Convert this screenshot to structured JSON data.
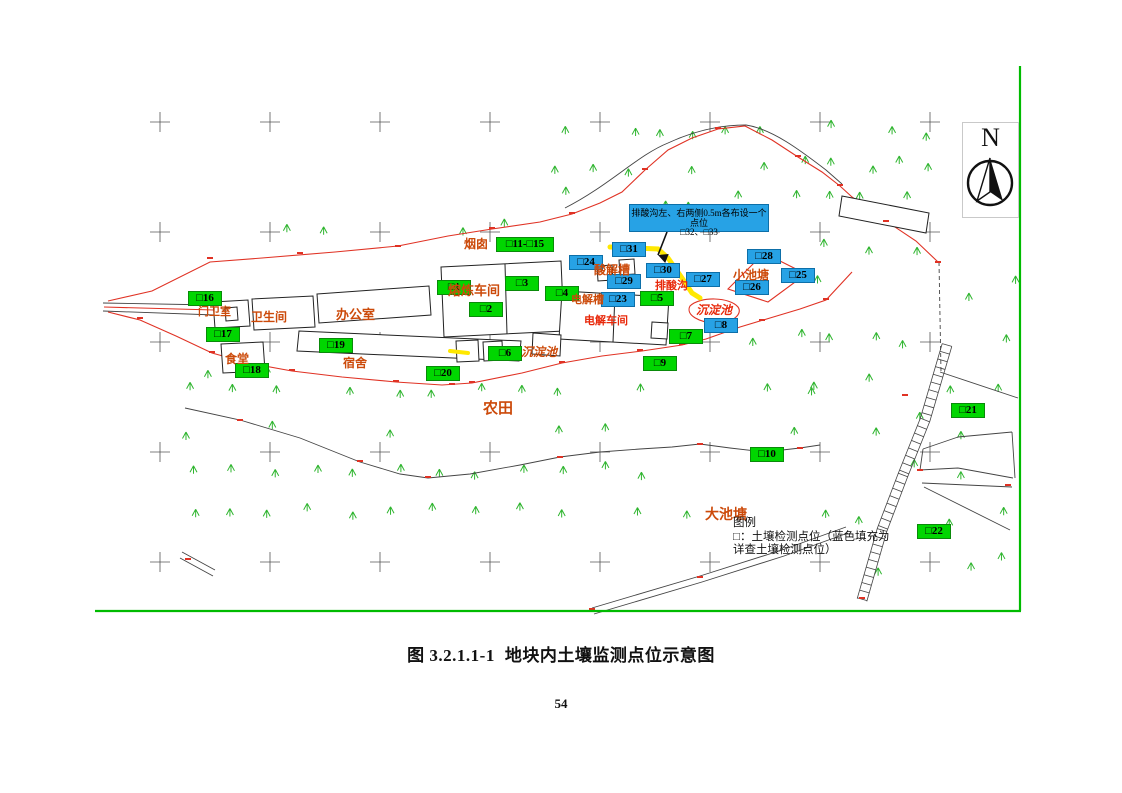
{
  "figure": {
    "caption_no": "图 3.2.1.1-1",
    "caption_title": "地块内土壤监测点位示意图",
    "page_number": "54"
  },
  "north": {
    "label": "N"
  },
  "callout": {
    "line1": "排酸沟左、右两侧0.5m各布设一个点位",
    "line2": "□32、□33"
  },
  "legend": {
    "title": "图例",
    "line1": "□：土壤检测点位（蓝色填充为",
    "line2": "详查土壤检测点位）"
  },
  "colors": {
    "point_green": "#00D600",
    "point_blue": "#27A2E5",
    "boundary_red": "#E03224",
    "label_orange": "#CC4A0A",
    "label_red": "#E8280A",
    "ditch_yellow": "#FFE800",
    "frame_green": "#00BB00",
    "tree_green": "#2FB52F"
  },
  "points": [
    {
      "id": "1",
      "label": "□1",
      "x": 437,
      "y": 280,
      "type": "green"
    },
    {
      "id": "2",
      "label": "□2",
      "x": 469,
      "y": 302,
      "type": "green"
    },
    {
      "id": "3",
      "label": "□3",
      "x": 505,
      "y": 276,
      "type": "green"
    },
    {
      "id": "4",
      "label": "□4",
      "x": 545,
      "y": 286,
      "type": "green"
    },
    {
      "id": "5",
      "label": "□5",
      "x": 640,
      "y": 291,
      "type": "green"
    },
    {
      "id": "6",
      "label": "□6",
      "x": 488,
      "y": 346,
      "type": "green"
    },
    {
      "id": "7",
      "label": "□7",
      "x": 669,
      "y": 329,
      "type": "green"
    },
    {
      "id": "8",
      "label": "□8",
      "x": 704,
      "y": 318,
      "type": "blue"
    },
    {
      "id": "9",
      "label": "□9",
      "x": 643,
      "y": 356,
      "type": "green"
    },
    {
      "id": "10",
      "label": "□10",
      "x": 750,
      "y": 447,
      "type": "green"
    },
    {
      "id": "11-15",
      "label": "□11-□15",
      "x": 496,
      "y": 237,
      "type": "green",
      "w": 58
    },
    {
      "id": "16",
      "label": "□16",
      "x": 188,
      "y": 291,
      "type": "green"
    },
    {
      "id": "17",
      "label": "□17",
      "x": 206,
      "y": 327,
      "type": "green"
    },
    {
      "id": "18",
      "label": "□18",
      "x": 235,
      "y": 363,
      "type": "green"
    },
    {
      "id": "19",
      "label": "□19",
      "x": 319,
      "y": 338,
      "type": "green"
    },
    {
      "id": "20",
      "label": "□20",
      "x": 426,
      "y": 366,
      "type": "green"
    },
    {
      "id": "21",
      "label": "□21",
      "x": 951,
      "y": 403,
      "type": "green"
    },
    {
      "id": "22",
      "label": "□22",
      "x": 917,
      "y": 524,
      "type": "green"
    },
    {
      "id": "23",
      "label": "□23",
      "x": 601,
      "y": 292,
      "type": "blue"
    },
    {
      "id": "24",
      "label": "□24",
      "x": 569,
      "y": 255,
      "type": "blue"
    },
    {
      "id": "25",
      "label": "□25",
      "x": 781,
      "y": 268,
      "type": "blue"
    },
    {
      "id": "26",
      "label": "□26",
      "x": 735,
      "y": 280,
      "type": "blue"
    },
    {
      "id": "27",
      "label": "□27",
      "x": 686,
      "y": 272,
      "type": "blue"
    },
    {
      "id": "28",
      "label": "□28",
      "x": 747,
      "y": 249,
      "type": "blue"
    },
    {
      "id": "29",
      "label": "□29",
      "x": 607,
      "y": 274,
      "type": "blue"
    },
    {
      "id": "30",
      "label": "□30",
      "x": 646,
      "y": 263,
      "type": "blue"
    },
    {
      "id": "31",
      "label": "□31",
      "x": 612,
      "y": 242,
      "type": "blue"
    }
  ],
  "area_labels": [
    {
      "text": "烟囱",
      "x": 464,
      "y": 235,
      "s": 12,
      "c": "o"
    },
    {
      "text": "熔炼车间",
      "x": 448,
      "y": 280,
      "s": 13,
      "c": "o"
    },
    {
      "text": "办公室",
      "x": 336,
      "y": 304,
      "s": 13,
      "c": "o"
    },
    {
      "text": "门卫室",
      "x": 198,
      "y": 303,
      "s": 11,
      "c": "o"
    },
    {
      "text": "卫生间",
      "x": 251,
      "y": 308,
      "s": 12,
      "c": "o"
    },
    {
      "text": "食堂",
      "x": 225,
      "y": 350,
      "s": 12,
      "c": "o"
    },
    {
      "text": "宿舍",
      "x": 343,
      "y": 354,
      "s": 12,
      "c": "o"
    },
    {
      "text": "酸解槽",
      "x": 594,
      "y": 261,
      "s": 12,
      "c": "o"
    },
    {
      "text": "排酸沟",
      "x": 655,
      "y": 277,
      "s": 11,
      "c": "r"
    },
    {
      "text": "电解槽",
      "x": 571,
      "y": 291,
      "s": 11,
      "c": "o"
    },
    {
      "text": "电解车间",
      "x": 584,
      "y": 312,
      "s": 11,
      "c": "r"
    },
    {
      "text": "沉淀池",
      "x": 521,
      "y": 343,
      "s": 12,
      "c": "o",
      "i": true
    },
    {
      "text": "沉淀池",
      "x": 696,
      "y": 301,
      "s": 12,
      "c": "r",
      "i": true
    },
    {
      "text": "小池塘",
      "x": 733,
      "y": 266,
      "s": 12,
      "c": "o"
    },
    {
      "text": "农田",
      "x": 483,
      "y": 397,
      "s": 15,
      "c": "o"
    },
    {
      "text": "大池塘",
      "x": 705,
      "y": 504,
      "s": 14,
      "c": "o"
    }
  ]
}
